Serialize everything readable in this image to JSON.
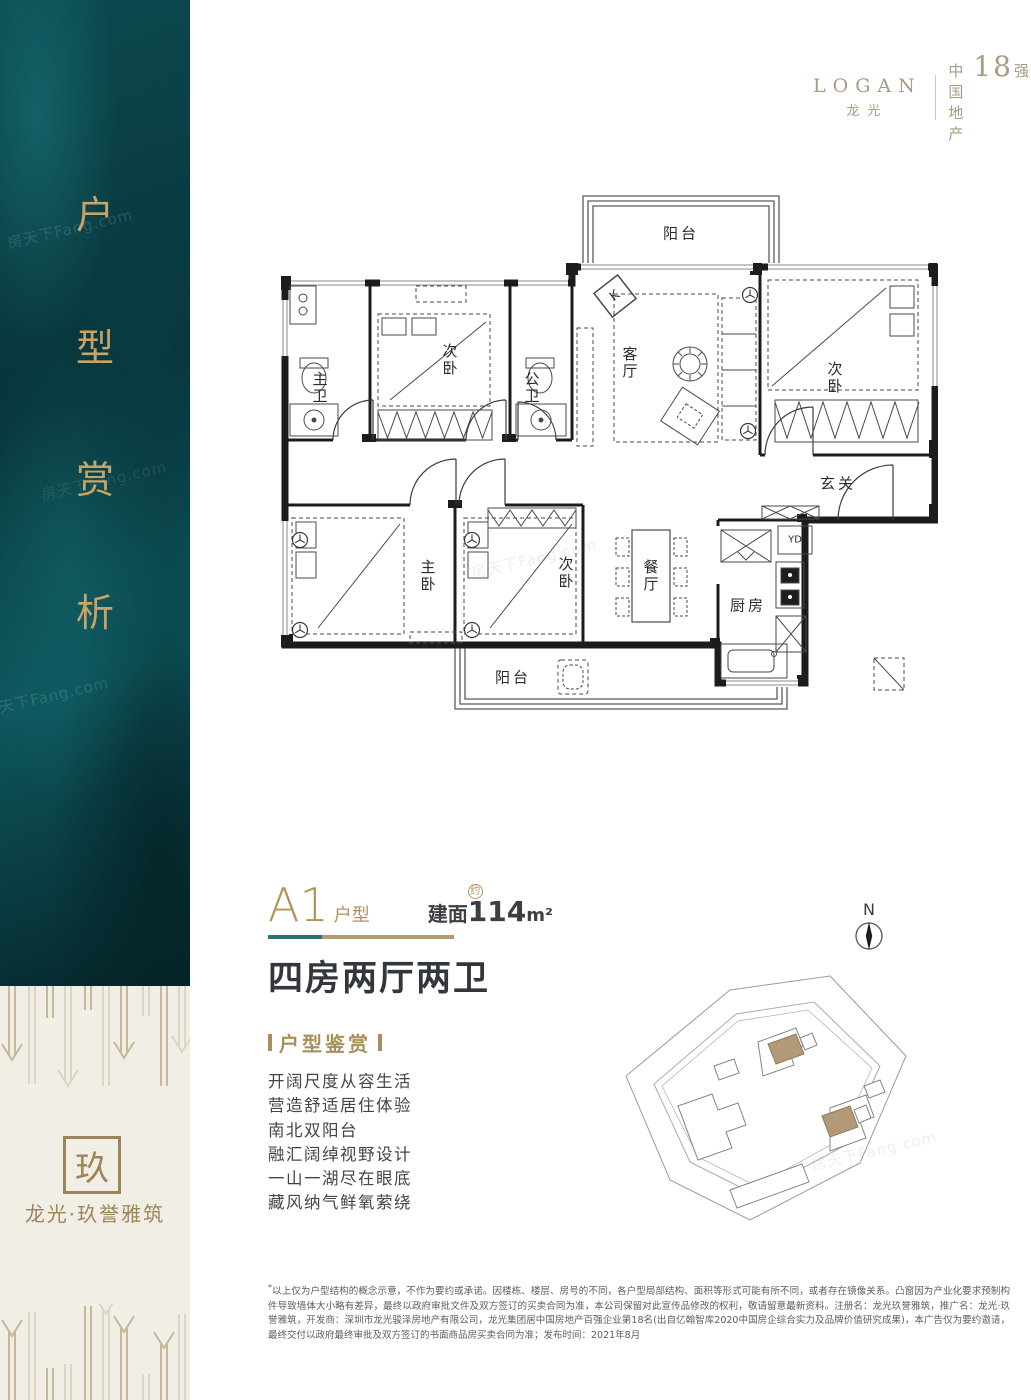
{
  "brand": {
    "logo": "LOGAN",
    "logo_cn": "龙光",
    "rank_prefix": "中国地产",
    "rank_number": "18",
    "rank_suffix": "强"
  },
  "sidebar": {
    "title_chars": [
      "户",
      "型",
      "赏",
      "析"
    ],
    "watermark": "房天下Fang.com"
  },
  "project": {
    "seal": "玖",
    "name": "龙光·玖誉雅筑"
  },
  "unit": {
    "code": "A1",
    "code_label": "户型",
    "area_prefix": "建面",
    "area_approx": "约",
    "area_value": "114",
    "area_unit": "m²",
    "headline": "四房两厅两卫"
  },
  "appreciation": {
    "title": "户型鉴赏",
    "features": [
      "开阔尺度从容生活",
      "营造舒适居住体验",
      "南北双阳台",
      "融汇阔绰视野设计",
      "一山一湖尽在眼底",
      "藏风纳气鲜氧萦绕"
    ]
  },
  "floorplan": {
    "rooms": {
      "balcony_top": "阳台",
      "bath_master": "主卫",
      "bed_top": "次卧",
      "bath_public": "公卫",
      "living": "客厅",
      "bed_right": "次卧",
      "entry": "玄关",
      "bed_master": "主卧",
      "bed_mid": "次卧",
      "dining": "餐厅",
      "kitchen": "厨房",
      "duct": "YD",
      "balcony_bottom": "阳台",
      "marker_k": "K"
    }
  },
  "siteplan": {
    "north": "N"
  },
  "disclaimer": {
    "mark": "*",
    "text": "以上仅为户型结构的概念示意，不作为要约或承诺。因楼栋、楼层、房号的不同，各户型局部结构、面积等形式可能有所不同，或者存在镜像关系。凸窗因为产业化要求预制构件导致墙体大小略有差异，最终以政府审批文件及双方签订的买卖合同为准，本公司保留对此宣传品修改的权利，敬请留意最新资料。注册名：龙光玖誉雅筑，推广名：龙光·玖誉雅筑，开发商：深圳市龙光骏泽房地产有限公司，龙光集团居中国房地产百强企业第18名(出自亿翰智库2020中国房企综合实力及品牌价值研究成果)，本广告仅为要约邀请，最终交付以政府最终审批及双方签订的书面商品房买卖合同为准；发布时间：2021年8月"
  }
}
